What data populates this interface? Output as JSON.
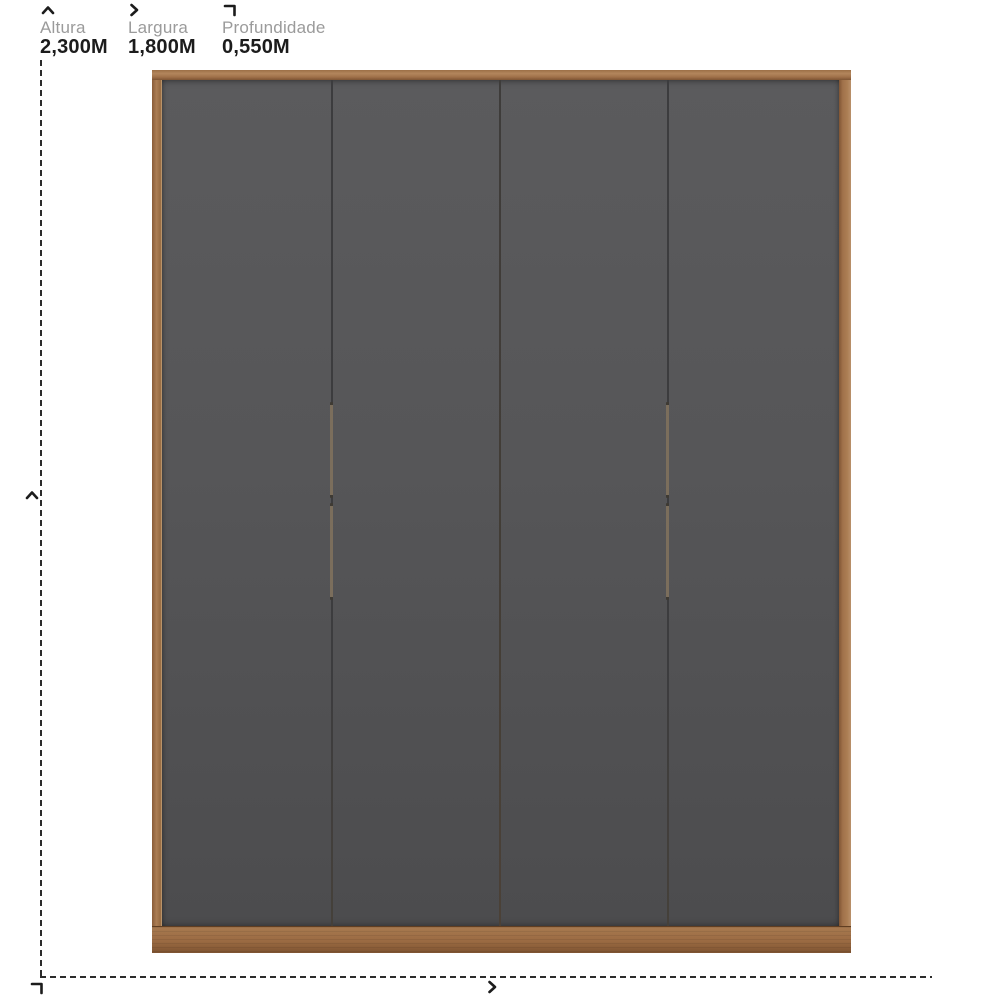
{
  "legend": {
    "items": [
      {
        "label": "Altura",
        "value": "2,300M",
        "icon": "chevron-up-icon"
      },
      {
        "label": "Largura",
        "value": "1,800M",
        "icon": "chevron-right-icon"
      },
      {
        "label": "Profundidade",
        "value": "0,550M",
        "icon": "corner-depth-icon"
      }
    ]
  },
  "product": {
    "type": "wardrobe",
    "door_count": 4,
    "handle_count": 4
  },
  "colors": {
    "background": "#ffffff",
    "label_gray": "#9b9b9b",
    "value_black": "#1c1c1c",
    "dash_line": "#2b2b2b",
    "wood_frame": "#a0714a",
    "door_gray": "#545456",
    "handle_bronze": "#7b6e5c"
  }
}
